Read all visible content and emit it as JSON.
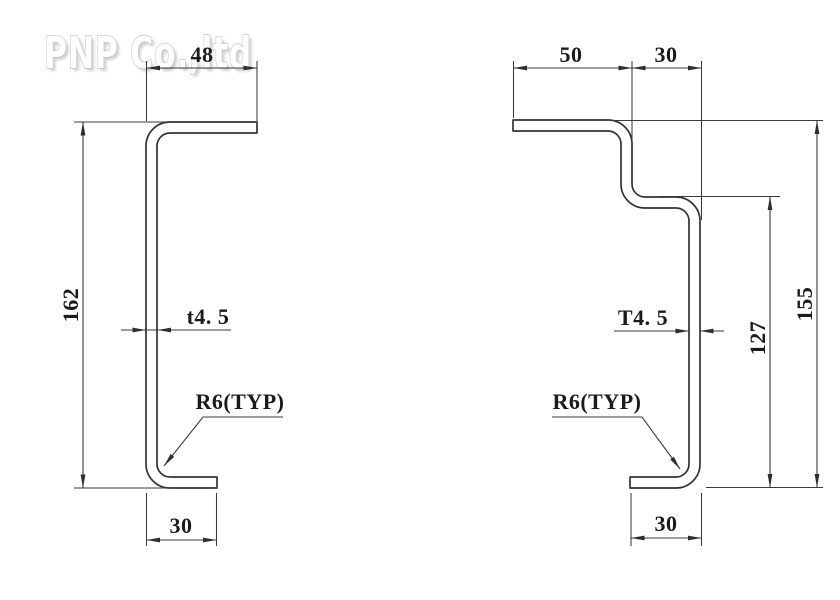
{
  "watermark": {
    "text": "PNP Co.,ltd"
  },
  "colors": {
    "background": "#ffffff",
    "line": "#333333",
    "dimension": "#3a3a3a",
    "text": "#1b1b1b",
    "watermark_fill": "#ffffff",
    "watermark_outline": "#c4c4c4"
  },
  "left_profile": {
    "labels": {
      "top_width": "48",
      "height": "162",
      "thickness": "t4. 5",
      "bend_radius": "R6(TYP)",
      "bottom_width": "30"
    }
  },
  "right_profile": {
    "labels": {
      "top_flange_width": "50",
      "step_width": "30",
      "overall_height": "155",
      "inner_height": "127",
      "thickness": "T4. 5",
      "bend_radius": "R6(TYP)",
      "bottom_width": "30"
    }
  }
}
